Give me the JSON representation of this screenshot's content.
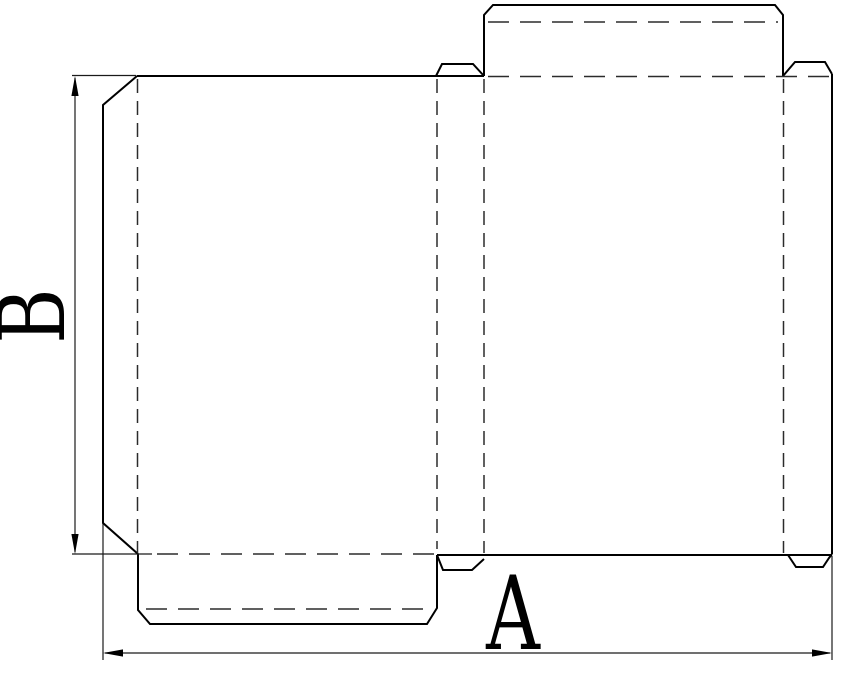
{
  "diagram": {
    "kind": "box-dieline-flat-pattern",
    "background_color": "#ffffff",
    "line_color": "#000000",
    "dimension_labels": {
      "width": "A",
      "height": "B"
    }
  }
}
